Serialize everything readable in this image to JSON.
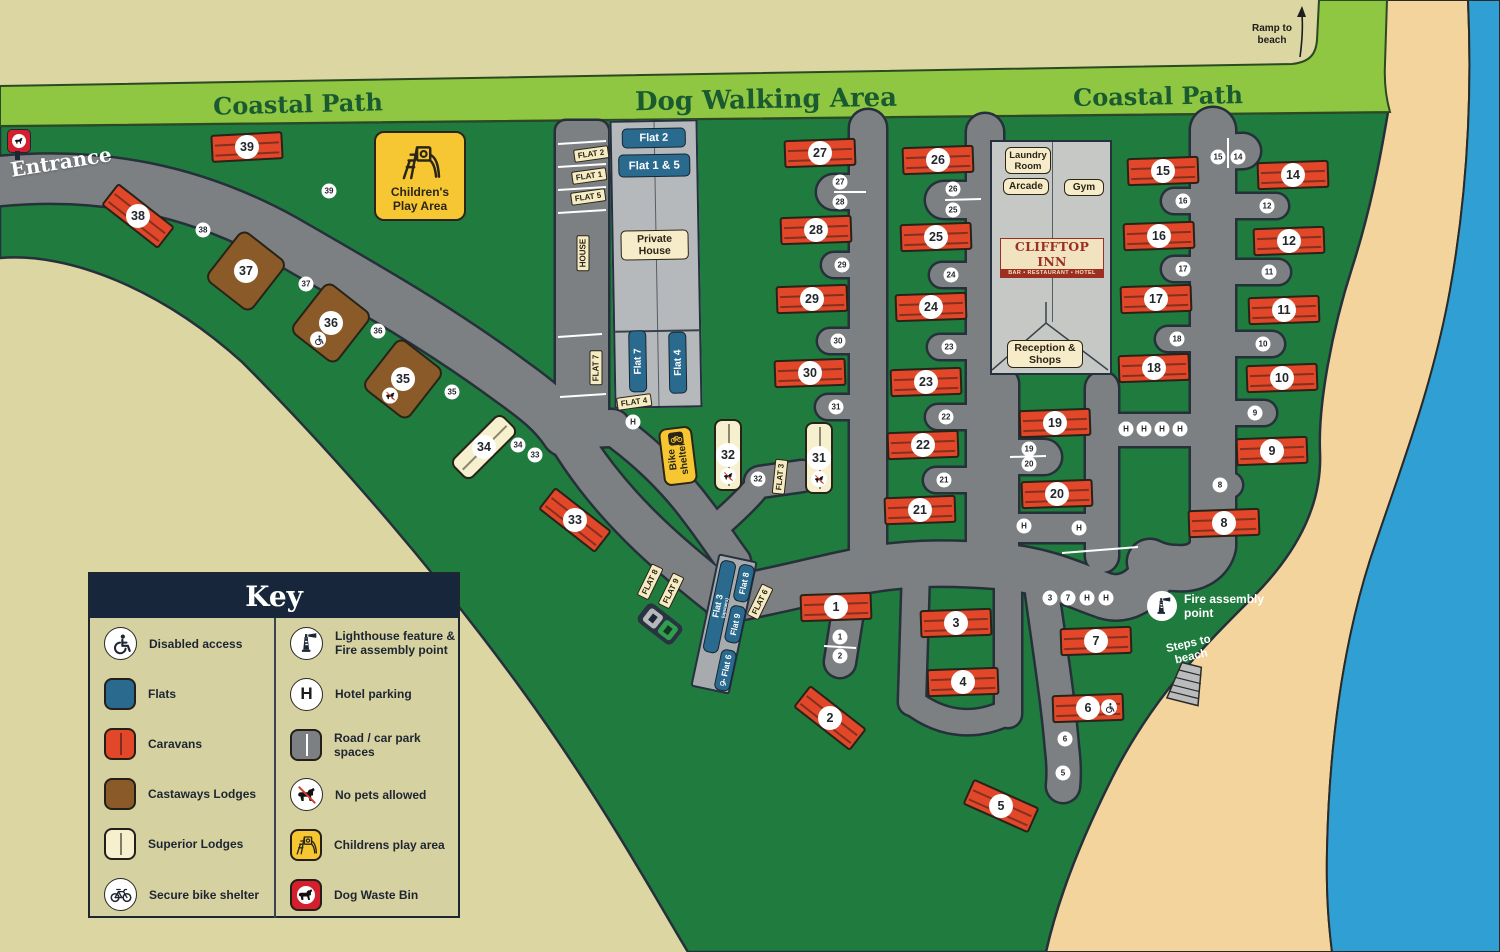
{
  "labels": {
    "coastal_path_left": "Coastal Path",
    "dog_walking_area": "Dog Walking Area",
    "coastal_path_right": "Coastal Path",
    "ramp_to_beach": "Ramp to beach",
    "entrance": "Entrance",
    "steps_to_beach": "Steps to beach",
    "fire_assembly": "Fire assembly point"
  },
  "play_area": {
    "label": "Children's Play Area"
  },
  "bike_shelter": {
    "label": "Bike shelter"
  },
  "north_flats": {
    "flat2": "Flat 2",
    "flat15": "Flat 1 & 5",
    "private_house": "Private House",
    "flat7": "Flat 7",
    "flat4": "Flat 4"
  },
  "clifftop": {
    "laundry": "Laundry Room",
    "arcade": "Arcade",
    "gym": "Gym",
    "inn_name": "CLIFFTOP INN",
    "inn_sub": "BAR • RESTAURANT • HOTEL",
    "reception": "Reception & Shops"
  },
  "south_flats": {
    "flat3": "Flat 3",
    "flat3_sub": "(upstairs)",
    "flat8": "Flat 8",
    "flat9": "Flat 9",
    "flat6": "Flat 6"
  },
  "key": {
    "title": "Key",
    "left": [
      {
        "icon": "disabled",
        "label": "Disabled access"
      },
      {
        "icon": "flats",
        "label": "Flats"
      },
      {
        "icon": "caravans",
        "label": "Caravans"
      },
      {
        "icon": "castaways",
        "label": "Castaways Lodges"
      },
      {
        "icon": "superior",
        "label": "Superior Lodges"
      },
      {
        "icon": "bike",
        "label": "Secure bike shelter"
      }
    ],
    "right": [
      {
        "icon": "lighthouse",
        "label": "Lighthouse feature & Fire assembly point"
      },
      {
        "icon": "hotelparking",
        "label": "Hotel parking"
      },
      {
        "icon": "road",
        "label": "Road / car park spaces"
      },
      {
        "icon": "nopets",
        "label": "No pets allowed"
      },
      {
        "icon": "playarea",
        "label": "Childrens play area"
      },
      {
        "icon": "dogbin",
        "label": "Dog Waste Bin"
      }
    ]
  },
  "units": [
    {
      "n": "1",
      "t": "caravan",
      "x": 836,
      "y": 607,
      "r": -2
    },
    {
      "n": "2",
      "t": "caravan",
      "x": 830,
      "y": 718,
      "r": 38
    },
    {
      "n": "3",
      "t": "caravan",
      "x": 956,
      "y": 623,
      "r": -2
    },
    {
      "n": "4",
      "t": "caravan",
      "x": 963,
      "y": 682,
      "r": -2
    },
    {
      "n": "5",
      "t": "caravan",
      "x": 1001,
      "y": 806,
      "r": 24
    },
    {
      "n": "6",
      "t": "caravan",
      "x": 1088,
      "y": 708,
      "r": -2,
      "b": "disabled"
    },
    {
      "n": "7",
      "t": "caravan",
      "x": 1096,
      "y": 641,
      "r": -2
    },
    {
      "n": "8",
      "t": "caravan",
      "x": 1224,
      "y": 523,
      "r": -2
    },
    {
      "n": "9",
      "t": "caravan",
      "x": 1272,
      "y": 451,
      "r": -2
    },
    {
      "n": "10",
      "t": "caravan",
      "x": 1282,
      "y": 378,
      "r": -2
    },
    {
      "n": "11",
      "t": "caravan",
      "x": 1284,
      "y": 310,
      "r": -2
    },
    {
      "n": "12",
      "t": "caravan",
      "x": 1289,
      "y": 241,
      "r": -2
    },
    {
      "n": "14",
      "t": "caravan",
      "x": 1293,
      "y": 175,
      "r": -2
    },
    {
      "n": "15",
      "t": "caravan",
      "x": 1163,
      "y": 171,
      "r": -2
    },
    {
      "n": "16",
      "t": "caravan",
      "x": 1159,
      "y": 236,
      "r": -2
    },
    {
      "n": "17",
      "t": "caravan",
      "x": 1156,
      "y": 299,
      "r": -2
    },
    {
      "n": "18",
      "t": "caravan",
      "x": 1154,
      "y": 368,
      "r": -2
    },
    {
      "n": "19",
      "t": "caravan",
      "x": 1055,
      "y": 423,
      "r": -2
    },
    {
      "n": "20",
      "t": "caravan",
      "x": 1057,
      "y": 494,
      "r": -2
    },
    {
      "n": "21",
      "t": "caravan",
      "x": 920,
      "y": 510,
      "r": -2
    },
    {
      "n": "22",
      "t": "caravan",
      "x": 923,
      "y": 445,
      "r": -2
    },
    {
      "n": "23",
      "t": "caravan",
      "x": 926,
      "y": 382,
      "r": -2
    },
    {
      "n": "24",
      "t": "caravan",
      "x": 931,
      "y": 307,
      "r": -2
    },
    {
      "n": "25",
      "t": "caravan",
      "x": 936,
      "y": 237,
      "r": -2
    },
    {
      "n": "26",
      "t": "caravan",
      "x": 938,
      "y": 160,
      "r": -2
    },
    {
      "n": "27",
      "t": "caravan",
      "x": 820,
      "y": 153,
      "r": -2
    },
    {
      "n": "28",
      "t": "caravan",
      "x": 816,
      "y": 230,
      "r": -2
    },
    {
      "n": "29",
      "t": "caravan",
      "x": 812,
      "y": 299,
      "r": -2
    },
    {
      "n": "30",
      "t": "caravan",
      "x": 810,
      "y": 373,
      "r": -2
    },
    {
      "n": "31",
      "t": "superior",
      "x": 819,
      "y": 458,
      "r": 0,
      "b": "nopets"
    },
    {
      "n": "32",
      "t": "superior",
      "x": 728,
      "y": 455,
      "r": 0,
      "b": "nopets"
    },
    {
      "n": "33",
      "t": "caravan",
      "x": 575,
      "y": 520,
      "r": 38
    },
    {
      "n": "34",
      "t": "superior",
      "x": 484,
      "y": 447,
      "r": 45
    },
    {
      "n": "35",
      "t": "castaways",
      "x": 403,
      "y": 379,
      "r": 38,
      "b": "nopets"
    },
    {
      "n": "36",
      "t": "castaways",
      "x": 331,
      "y": 323,
      "r": 38,
      "b": "disabled"
    },
    {
      "n": "37",
      "t": "castaways",
      "x": 246,
      "y": 271,
      "r": 38
    },
    {
      "n": "38",
      "t": "caravan",
      "x": 138,
      "y": 216,
      "r": 38
    },
    {
      "n": "39",
      "t": "caravan",
      "x": 247,
      "y": 147,
      "r": -3
    }
  ],
  "parking_spots": [
    {
      "t": "39",
      "x": 329,
      "y": 191
    },
    {
      "t": "38",
      "x": 203,
      "y": 230
    },
    {
      "t": "37",
      "x": 306,
      "y": 284
    },
    {
      "t": "36",
      "x": 378,
      "y": 331
    },
    {
      "t": "35",
      "x": 452,
      "y": 392
    },
    {
      "t": "34",
      "x": 518,
      "y": 445
    },
    {
      "t": "33",
      "x": 535,
      "y": 455
    },
    {
      "t": "32",
      "x": 758,
      "y": 479
    },
    {
      "t": "31",
      "x": 836,
      "y": 407
    },
    {
      "t": "30",
      "x": 838,
      "y": 341
    },
    {
      "t": "29",
      "x": 842,
      "y": 265
    },
    {
      "t": "28",
      "x": 840,
      "y": 202
    },
    {
      "t": "27",
      "x": 840,
      "y": 182
    },
    {
      "t": "26",
      "x": 953,
      "y": 189
    },
    {
      "t": "25",
      "x": 953,
      "y": 210
    },
    {
      "t": "24",
      "x": 951,
      "y": 275
    },
    {
      "t": "23",
      "x": 949,
      "y": 347
    },
    {
      "t": "22",
      "x": 946,
      "y": 417
    },
    {
      "t": "21",
      "x": 944,
      "y": 480
    },
    {
      "t": "19",
      "x": 1029,
      "y": 449
    },
    {
      "t": "20",
      "x": 1029,
      "y": 464
    },
    {
      "t": "18",
      "x": 1177,
      "y": 339
    },
    {
      "t": "17",
      "x": 1183,
      "y": 269
    },
    {
      "t": "16",
      "x": 1183,
      "y": 201
    },
    {
      "t": "15",
      "x": 1218,
      "y": 157
    },
    {
      "t": "14",
      "x": 1238,
      "y": 157
    },
    {
      "t": "12",
      "x": 1267,
      "y": 206
    },
    {
      "t": "11",
      "x": 1269,
      "y": 272
    },
    {
      "t": "10",
      "x": 1263,
      "y": 344
    },
    {
      "t": "9",
      "x": 1255,
      "y": 413
    },
    {
      "t": "8",
      "x": 1220,
      "y": 485
    },
    {
      "t": "H",
      "x": 1126,
      "y": 429
    },
    {
      "t": "H",
      "x": 1144,
      "y": 429
    },
    {
      "t": "H",
      "x": 1162,
      "y": 429
    },
    {
      "t": "H",
      "x": 1180,
      "y": 429
    },
    {
      "t": "H",
      "x": 1024,
      "y": 526
    },
    {
      "t": "H",
      "x": 1079,
      "y": 528
    },
    {
      "t": "3",
      "x": 1050,
      "y": 598
    },
    {
      "t": "7",
      "x": 1068,
      "y": 598
    },
    {
      "t": "H",
      "x": 1087,
      "y": 598
    },
    {
      "t": "H",
      "x": 1106,
      "y": 598
    },
    {
      "t": "1",
      "x": 840,
      "y": 637
    },
    {
      "t": "2",
      "x": 840,
      "y": 656
    },
    {
      "t": "6",
      "x": 1065,
      "y": 739
    },
    {
      "t": "5",
      "x": 1063,
      "y": 773
    },
    {
      "t": "H",
      "x": 633,
      "y": 422
    }
  ],
  "parking_labels": [
    {
      "t": "FLAT 2",
      "x": 591,
      "y": 154,
      "r": -8
    },
    {
      "t": "FLAT 1",
      "x": 589,
      "y": 176,
      "r": -8
    },
    {
      "t": "FLAT 5",
      "x": 588,
      "y": 197,
      "r": -8
    },
    {
      "t": "HOUSE",
      "x": 583,
      "y": 253,
      "r": -90
    },
    {
      "t": "FLAT 7",
      "x": 596,
      "y": 368,
      "r": -90
    },
    {
      "t": "FLAT 4",
      "x": 634,
      "y": 402,
      "r": -8
    },
    {
      "t": "FLAT 3",
      "x": 780,
      "y": 477,
      "r": -84
    },
    {
      "t": "FLAT 8",
      "x": 650,
      "y": 582,
      "r": -64
    },
    {
      "t": "FLAT 9",
      "x": 671,
      "y": 591,
      "r": -64
    },
    {
      "t": "FLAT 6",
      "x": 760,
      "y": 602,
      "r": -64
    }
  ],
  "colors": {
    "background": "#dcd6a2",
    "path_band": "#8fc642",
    "site_green": "#1f7c3e",
    "road": "#7d8083",
    "sand": "#f3d49d",
    "sea": "#2f9fd4",
    "caravan": "#e2472a",
    "castaways_lodge": "#8a5a28",
    "superior_lodge": "#f6f0cf",
    "flats_blue": "#2a6a8f",
    "key_header": "#17263b",
    "accent_yellow": "#f6c733",
    "dog_bin_red": "#d31f2e",
    "inn_red": "#9c2f22"
  }
}
